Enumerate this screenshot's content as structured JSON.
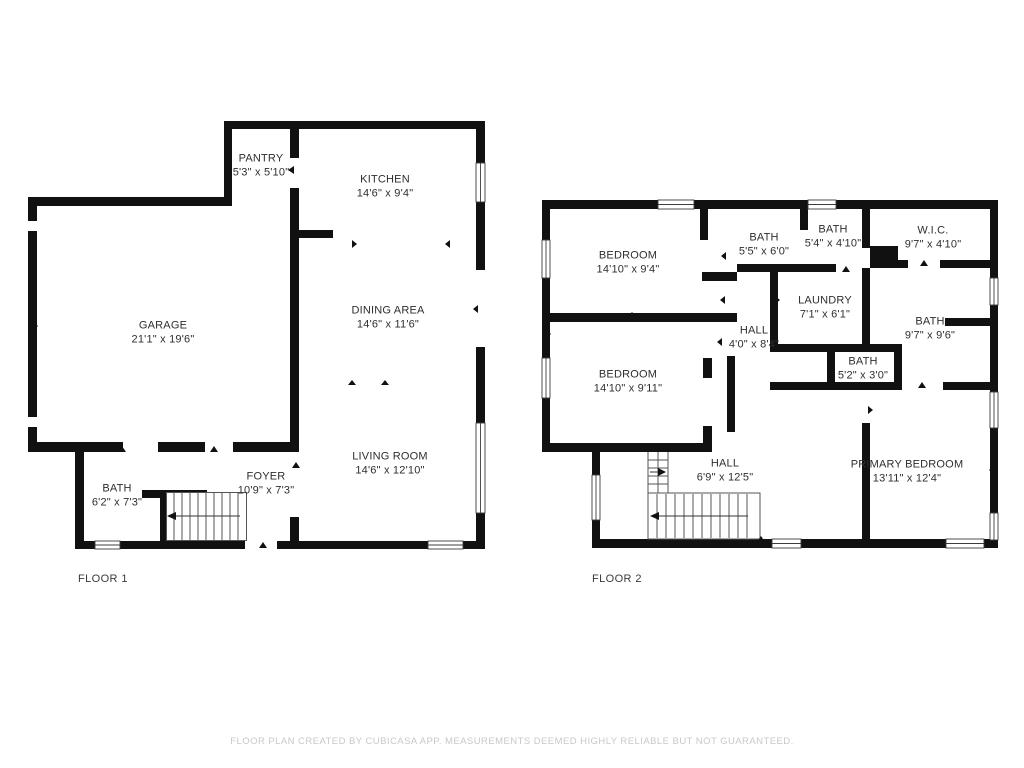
{
  "colors": {
    "wall": "#111111",
    "label_text": "#2e2e2e",
    "footer_text": "#c8c8c8"
  },
  "floor1": {
    "label": "FLOOR 1",
    "rooms": {
      "pantry": {
        "name": "PANTRY",
        "dims": "5'3\" x 5'10\""
      },
      "kitchen": {
        "name": "KITCHEN",
        "dims": "14'6\" x 9'4\""
      },
      "garage": {
        "name": "GARAGE",
        "dims": "21'1\" x 19'6\""
      },
      "dining": {
        "name": "DINING AREA",
        "dims": "14'6\" x 11'6\""
      },
      "living": {
        "name": "LIVING ROOM",
        "dims": "14'6\" x 12'10\""
      },
      "foyer": {
        "name": "FOYER",
        "dims": "10'9\" x 7'3\""
      },
      "bath": {
        "name": "BATH",
        "dims": "6'2\" x 7'3\""
      }
    }
  },
  "floor2": {
    "label": "FLOOR 2",
    "rooms": {
      "bedroom_upper": {
        "name": "BEDROOM",
        "dims": "14'10\" x 9'4\""
      },
      "bath_55": {
        "name": "BATH",
        "dims": "5'5\" x 6'0\""
      },
      "bath_54": {
        "name": "BATH",
        "dims": "5'4\" x 4'10\""
      },
      "wic": {
        "name": "W.I.C.",
        "dims": "9'7\" x 4'10\""
      },
      "laundry": {
        "name": "LAUNDRY",
        "dims": "7'1\" x 6'1\""
      },
      "bath_97": {
        "name": "BATH",
        "dims": "9'7\" x 9'6\""
      },
      "hall_upper": {
        "name": "HALL",
        "dims": "4'0\" x 8'4\""
      },
      "bath_52": {
        "name": "BATH",
        "dims": "5'2\" x 3'0\""
      },
      "bedroom_lower": {
        "name": "BEDROOM",
        "dims": "14'10\" x 9'11\""
      },
      "hall_lower": {
        "name": "HALL",
        "dims": "6'9\" x 12'5\""
      },
      "primary": {
        "name": "PRIMARY BEDROOM",
        "dims": "13'11\" x 12'4\""
      }
    }
  },
  "footer": {
    "disclaimer": "FLOOR PLAN CREATED BY CUBICASA APP. MEASUREMENTS DEEMED HIGHLY RELIABLE BUT NOT GUARANTEED."
  }
}
